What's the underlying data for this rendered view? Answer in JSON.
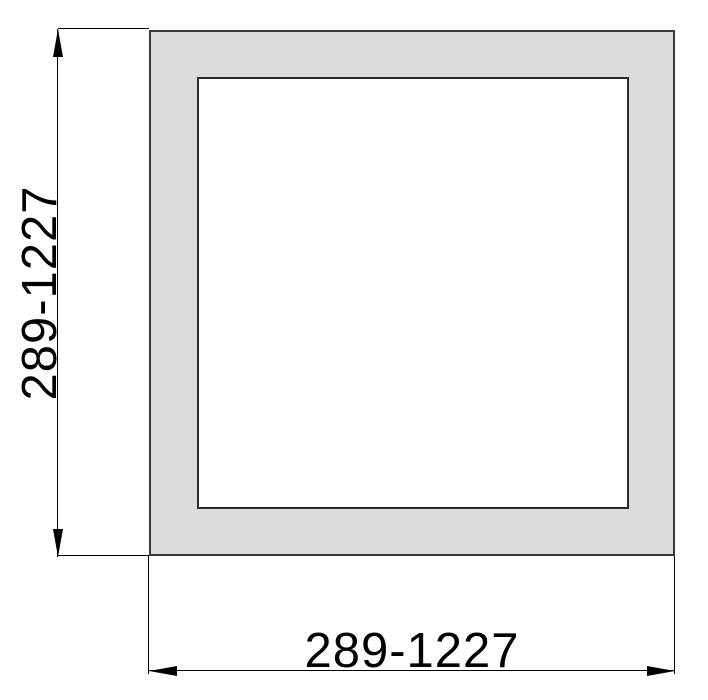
{
  "drawing": {
    "dimensions": {
      "height_label": "289-1227",
      "width_label": "289-1227"
    },
    "colors": {
      "background": "#ffffff",
      "section_fill": "#dcdcdc",
      "section_outline": "#3a3a3a",
      "bore_fill": "#ffffff",
      "dimension_line": "#000000",
      "text": "#000000"
    }
  }
}
